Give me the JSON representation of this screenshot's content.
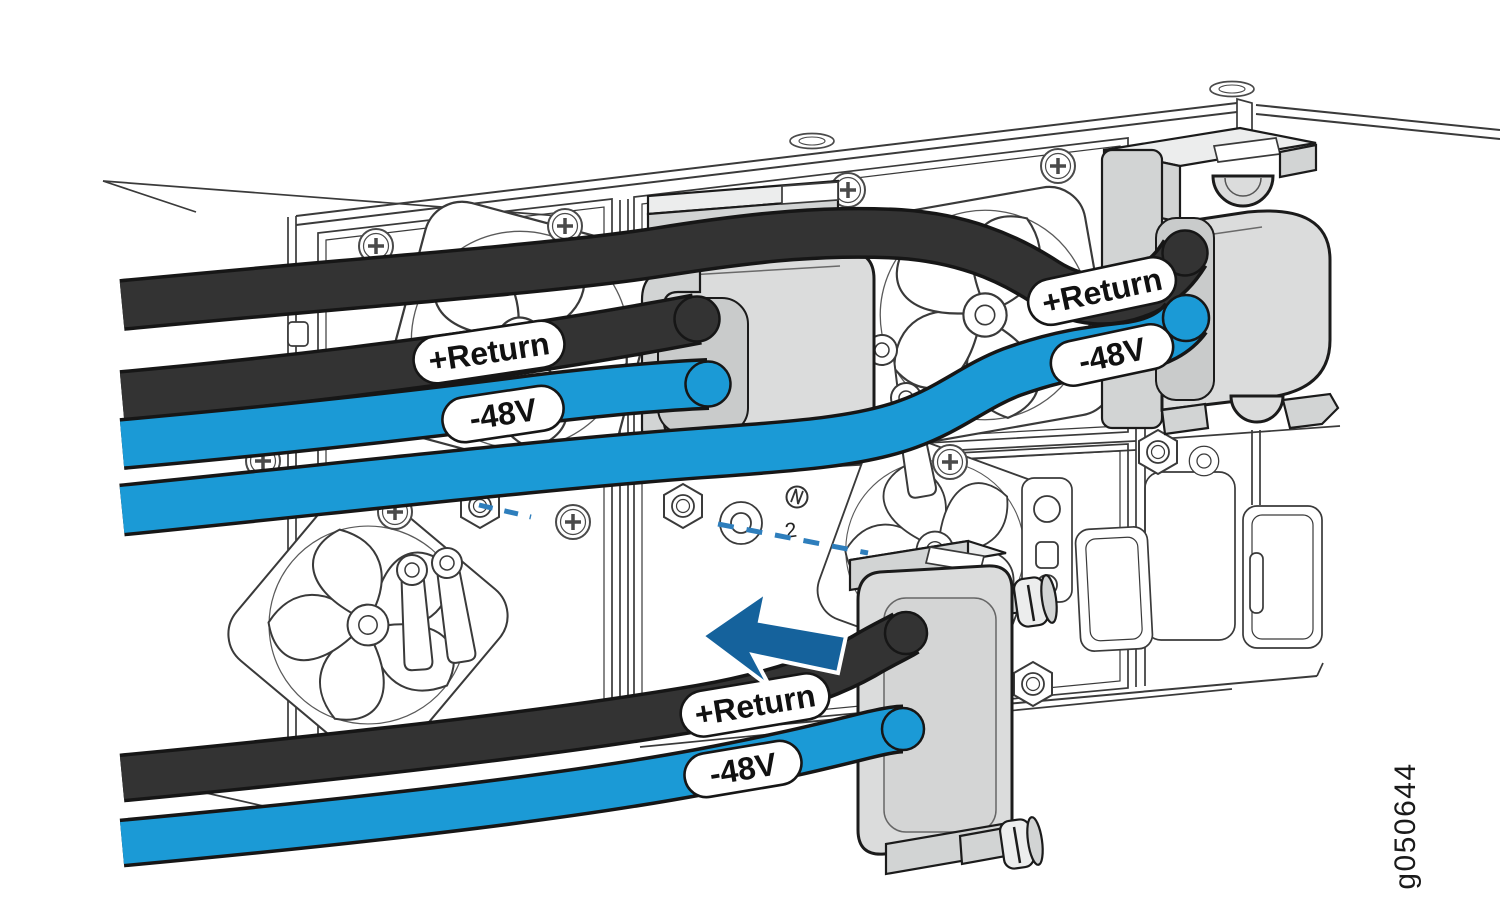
{
  "figure_id": "g050644",
  "description": "Rear chassis view showing DC power cable connector blocks attached to power supplies",
  "cable_labels": {
    "positive": "+Return",
    "negative": "-48V"
  },
  "cables": [
    {
      "pair": "upper-left-psu",
      "polarity": "positive",
      "color": "black",
      "label": "+Return"
    },
    {
      "pair": "upper-left-psu",
      "polarity": "negative",
      "color": "blue",
      "label": "-48V"
    },
    {
      "pair": "upper-right-psu",
      "polarity": "positive",
      "color": "black",
      "label": "+Return"
    },
    {
      "pair": "upper-right-psu",
      "polarity": "negative",
      "color": "blue",
      "label": "-48V"
    },
    {
      "pair": "lower-psu",
      "polarity": "positive",
      "color": "black",
      "label": "+Return"
    },
    {
      "pair": "lower-psu",
      "polarity": "negative",
      "color": "blue",
      "label": "-48V"
    }
  ],
  "annotations": {
    "insertion_arrow_direction": "left",
    "alignment_guide": "dashed",
    "terminal_marking": "2"
  },
  "colors": {
    "cable_black": "#333333",
    "cable_blue": "#1B9AD6",
    "arrow_blue": "#15629C",
    "dash_blue": "#2E7EBC",
    "connector_gray": "#DBDCDC",
    "connector_gray_dark": "#D2D4D4",
    "connector_gray_light": "#ECEDED",
    "recess_gray": "#C9CBCB",
    "line_dark": "#1B1B1B",
    "line_art": "#3A3A3A",
    "label_bg": "#FFFFFF",
    "label_text": "#111111"
  }
}
